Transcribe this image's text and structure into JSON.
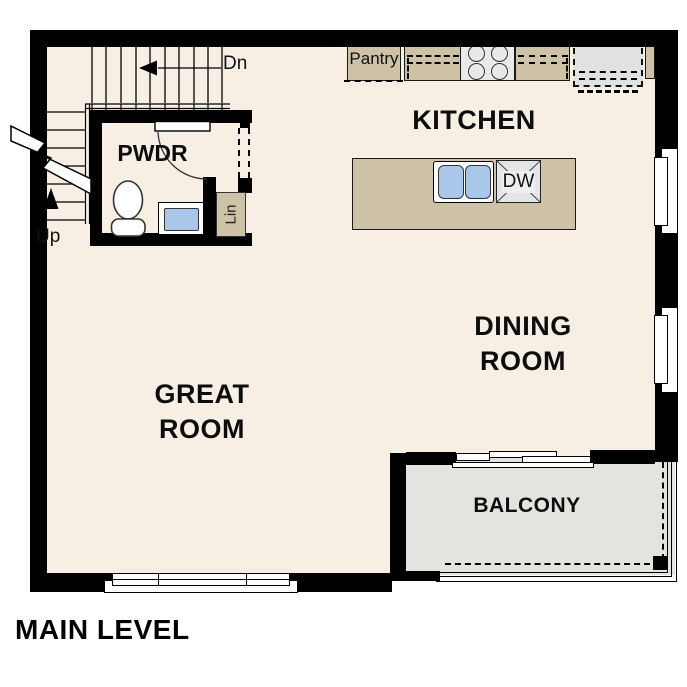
{
  "title": "MAIN LEVEL",
  "rooms": {
    "kitchen": "KITCHEN",
    "dining": {
      "line1": "DINING",
      "line2": "ROOM"
    },
    "great": {
      "line1": "GREAT",
      "line2": "ROOM"
    },
    "powder": "PWDR",
    "balcony": "BALCONY"
  },
  "fixtures": {
    "pantry": "Pantry",
    "dishwasher": "DW",
    "linen": "Lin"
  },
  "stairs": {
    "down": "Dn",
    "up": "Up"
  },
  "colors": {
    "background": "#ffffff",
    "wall": "#000000",
    "floor": "#f7efe3",
    "cabinet_tan": "#cdc1a6",
    "balcony_gray": "#e3e3e0",
    "appliance_gray": "#e7e9ea",
    "fridge_gray": "#dfe1e2",
    "sink_blue": "#a9c7e8"
  }
}
